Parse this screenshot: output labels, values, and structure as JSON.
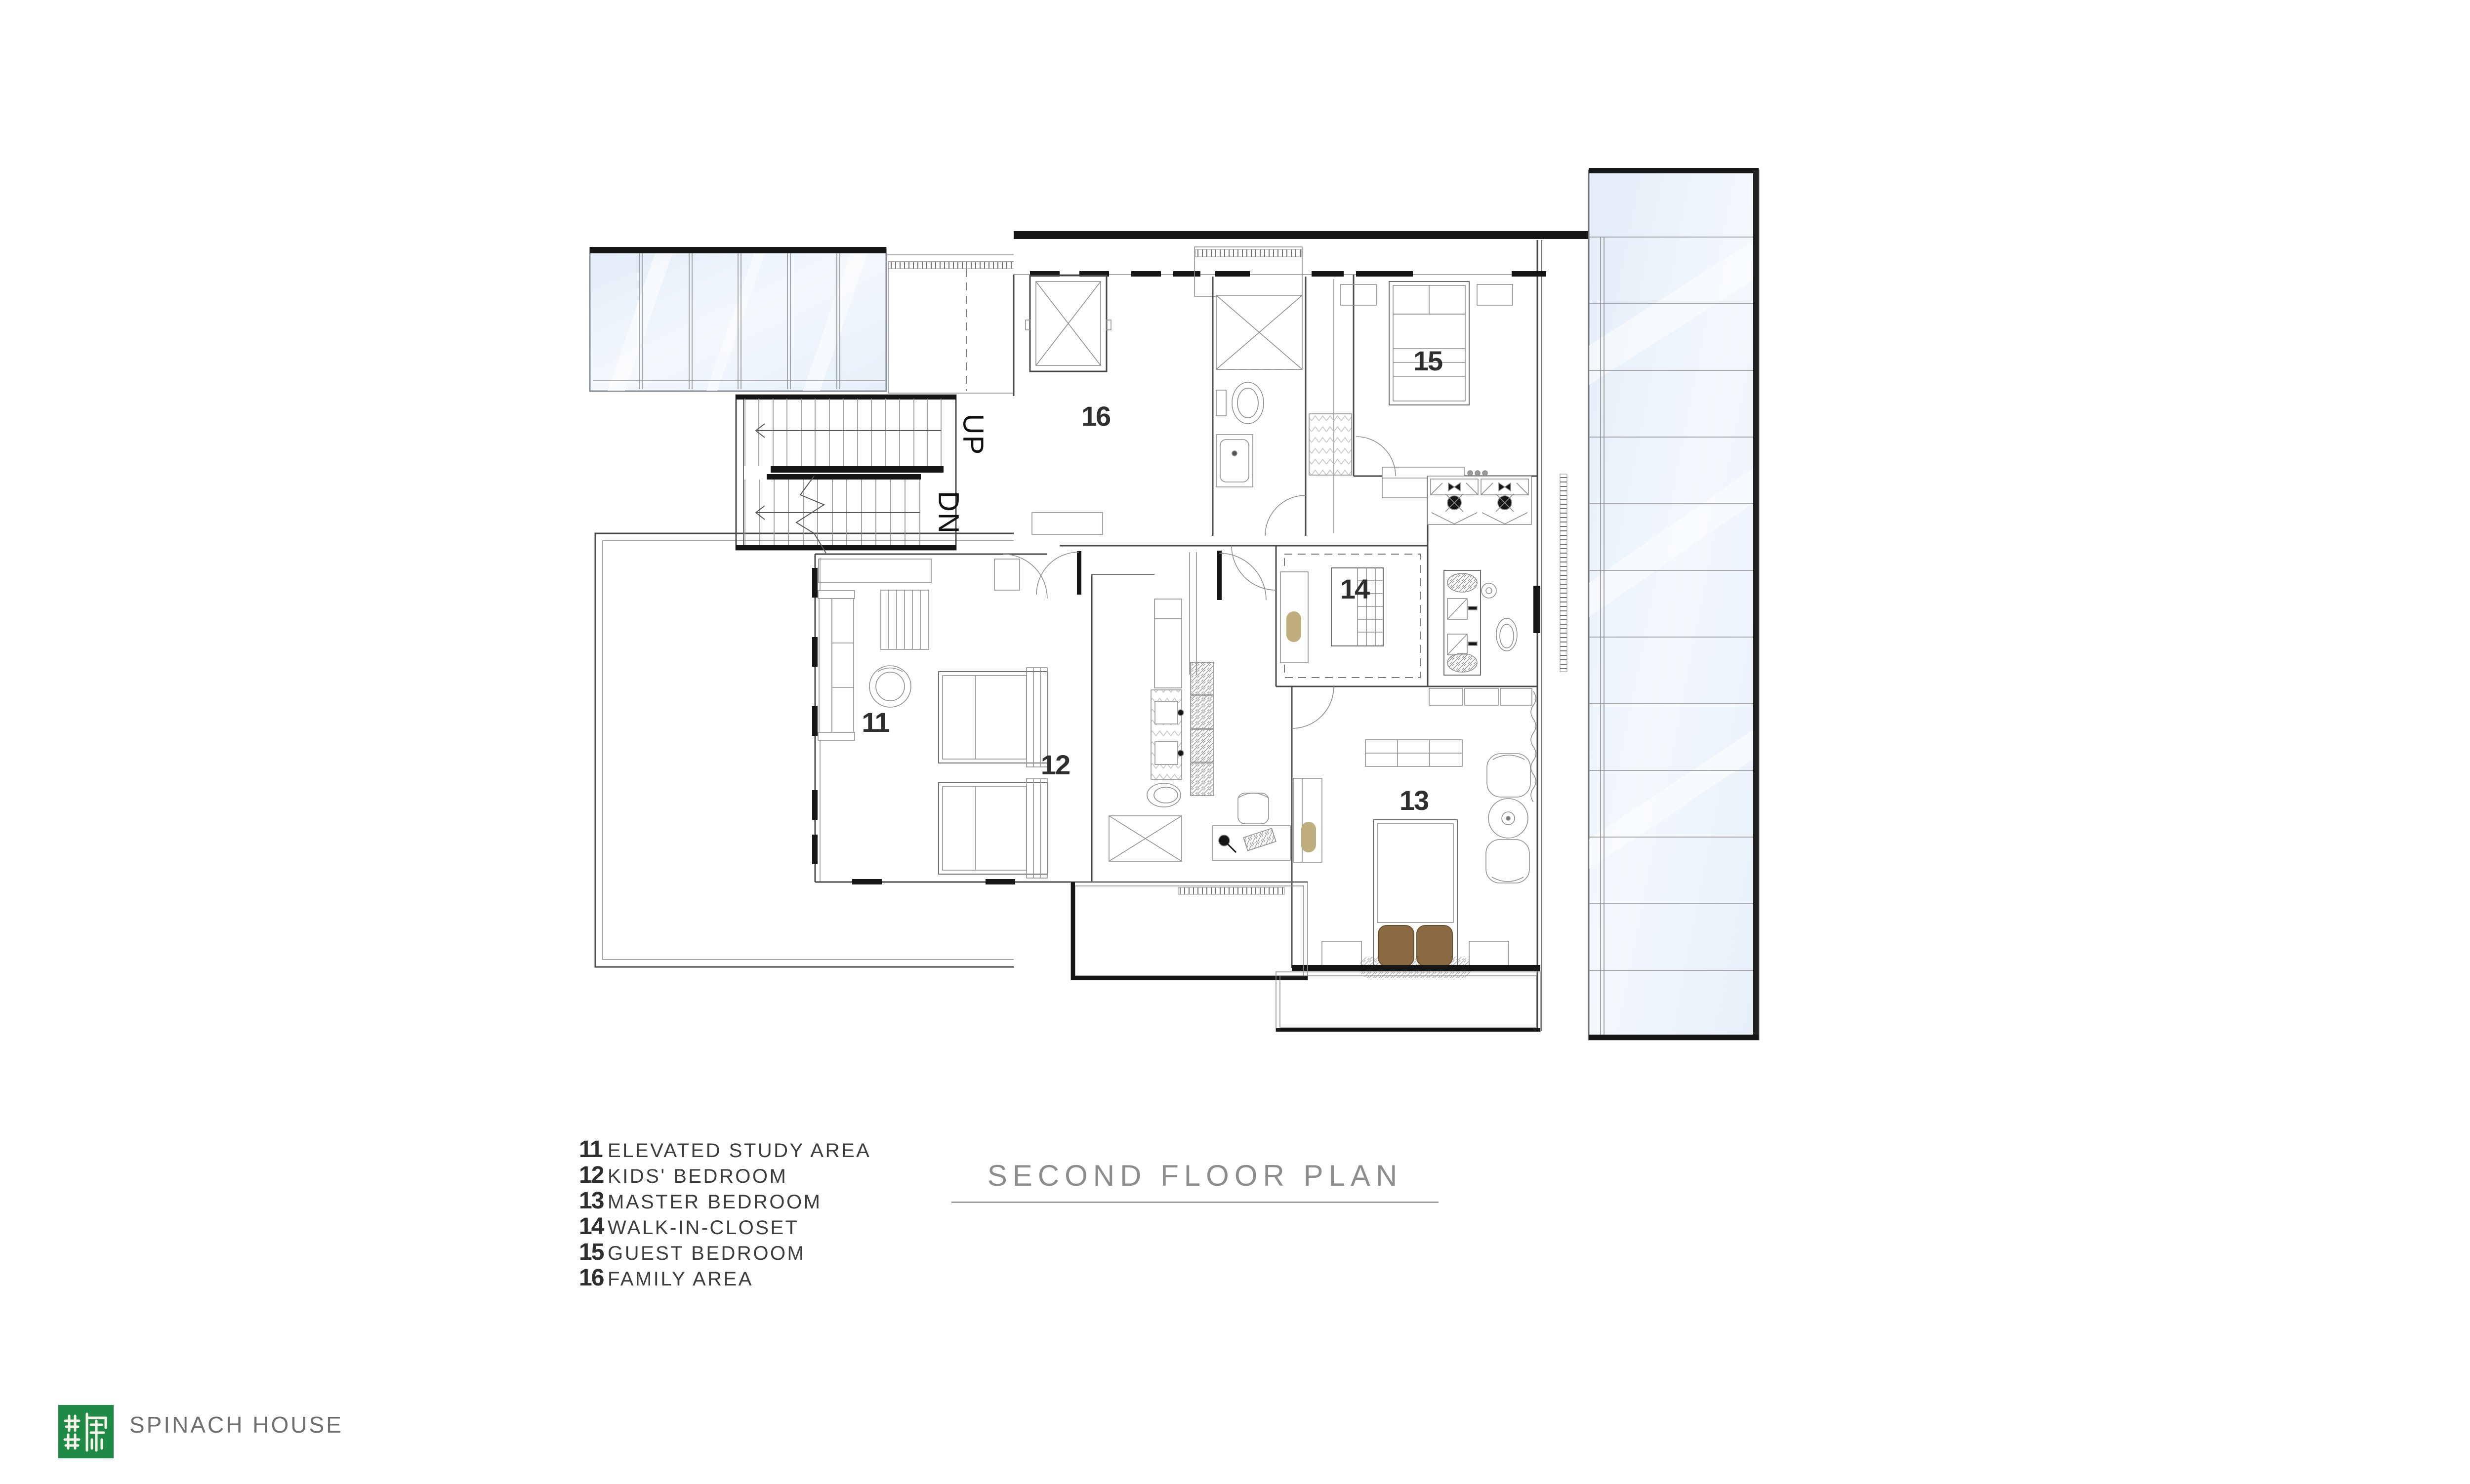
{
  "title": {
    "text": "SECOND FLOOR PLAN"
  },
  "legend": {
    "items": [
      {
        "num": "11",
        "label": "ELEVATED STUDY AREA"
      },
      {
        "num": "12",
        "label": "KIDS' BEDROOM"
      },
      {
        "num": "13",
        "label": "MASTER BEDROOM"
      },
      {
        "num": "14",
        "label": "WALK-IN-CLOSET"
      },
      {
        "num": "15",
        "label": "GUEST BEDROOM"
      },
      {
        "num": "16",
        "label": "FAMILY AREA"
      }
    ]
  },
  "plan": {
    "stairs": {
      "up": "UP",
      "down": "DN"
    }
  },
  "footer": {
    "brand": "SPINACH HOUSE"
  },
  "colors": {
    "logo_green": "#1e8a45",
    "brand_text": "#6f6f6f",
    "title_text": "#8d8d8d",
    "legend_text": "#3c3c3c",
    "line_dark": "#161616",
    "line_mid": "#4a4a4a",
    "line_light": "#9a9a9a",
    "glass_fill": "#e9f1fa",
    "accent_tan": "#bfae7e",
    "pillow_brown": "#8a6a42"
  }
}
